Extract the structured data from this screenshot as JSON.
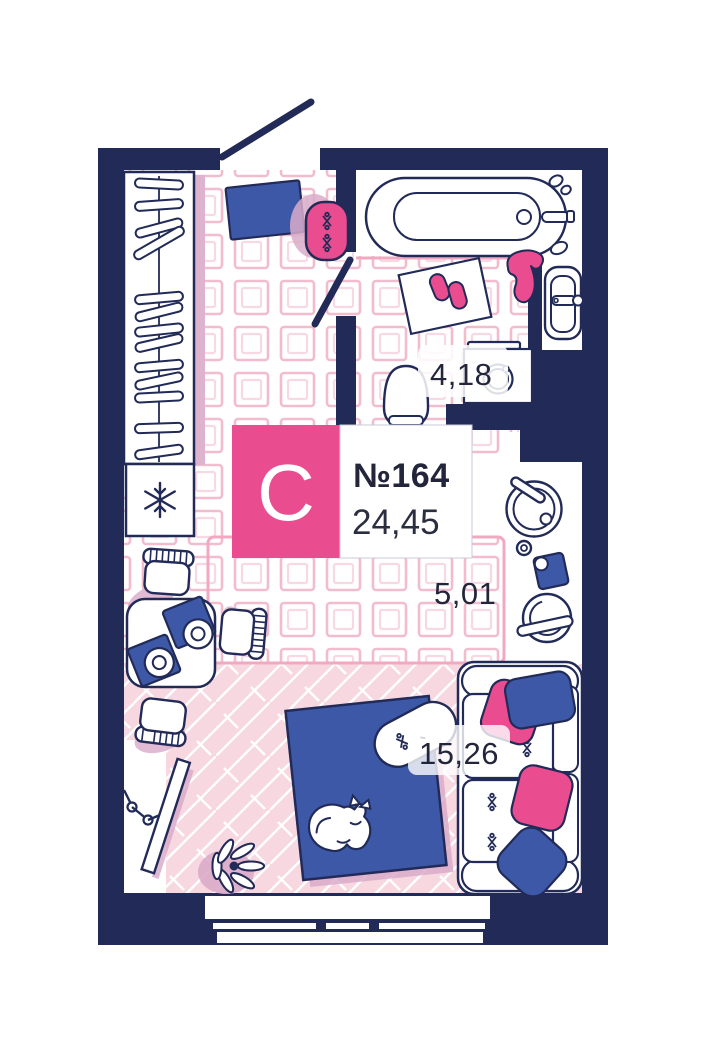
{
  "plan": {
    "unit": {
      "type_letter": "С",
      "number": "№164",
      "total_area": "24,45"
    },
    "rooms": [
      {
        "id": "bathroom",
        "area": "4,18"
      },
      {
        "id": "kitchen",
        "area": "5,01"
      },
      {
        "id": "living_room",
        "area": "15,26"
      }
    ]
  },
  "colors": {
    "walls_navy": "#222B58",
    "accent_pink": "#EA4D8F",
    "furniture_blue": "#3C58A7",
    "soft_shadow": "#D9ABC9",
    "tile_line_outer": "#F3BCCD",
    "tile_line_inner": "#F8D9E3",
    "herringbone_floor": "#F8D8E0",
    "zone_border_pink": "#F2A8C0",
    "label_text": "#23263B",
    "wardrobe_shadow": "#DEB3CD",
    "badge_border": "#C9CBD8"
  }
}
